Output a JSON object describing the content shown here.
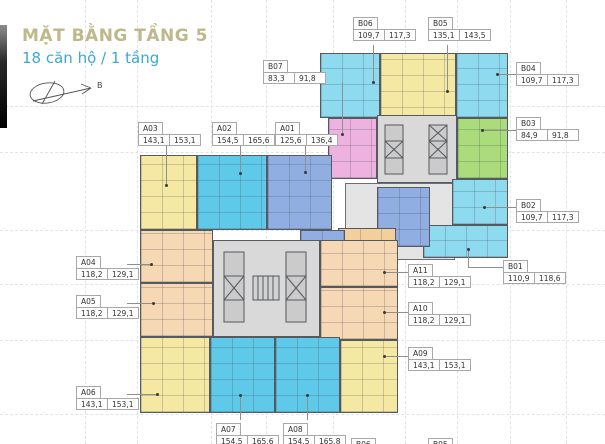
{
  "header": {
    "title": "MẶT BẰNG TẦNG 5",
    "subtitle": "18 căn hộ / 1 tầng",
    "compass_label": "B"
  },
  "colors": {
    "title_khaki": "#bfb88a",
    "subtitle_blue": "#3aa8d8",
    "cyan_light": "#8edaee",
    "cyan_deep": "#5ec9e9",
    "yellow": "#f5e8a2",
    "green": "#abdc7c",
    "pink": "#eeb2e0",
    "periwinkle": "#90aee2",
    "peach": "#f6d8b4",
    "orange": "#f3cf9e",
    "core_gray": "#d9d9d9"
  },
  "apartments": [
    {
      "id": "A01",
      "area1": "125,6",
      "area2": "136,4"
    },
    {
      "id": "A02",
      "area1": "154,5",
      "area2": "165,6"
    },
    {
      "id": "A03",
      "area1": "143,1",
      "area2": "153,1"
    },
    {
      "id": "A04",
      "area1": "118,2",
      "area2": "129,1"
    },
    {
      "id": "A05",
      "area1": "118,2",
      "area2": "129,1"
    },
    {
      "id": "A06",
      "area1": "143,1",
      "area2": "153,1"
    },
    {
      "id": "A07",
      "area1": "154,5",
      "area2": "165,6"
    },
    {
      "id": "A08",
      "area1": "154,5",
      "area2": "165,8"
    },
    {
      "id": "A09",
      "area1": "143,1",
      "area2": "153,1"
    },
    {
      "id": "A10",
      "area1": "118,2",
      "area2": "129,1"
    },
    {
      "id": "A11",
      "area1": "118,2",
      "area2": "129,1"
    },
    {
      "id": "B01",
      "area1": "110,9",
      "area2": "118,6"
    },
    {
      "id": "B02",
      "area1": "109,7",
      "area2": "117,3"
    },
    {
      "id": "B03",
      "area1": "84,9",
      "area2": "91,8"
    },
    {
      "id": "B04",
      "area1": "109,7",
      "area2": "117,3"
    },
    {
      "id": "B05",
      "area1": "135,1",
      "area2": "143,5"
    },
    {
      "id": "B06",
      "area1": "109,7",
      "area2": "117,3"
    },
    {
      "id": "B07",
      "area1": "83,3",
      "area2": "91,8"
    }
  ],
  "partial_labels": [
    {
      "id": "B06"
    },
    {
      "id": "B05"
    }
  ]
}
